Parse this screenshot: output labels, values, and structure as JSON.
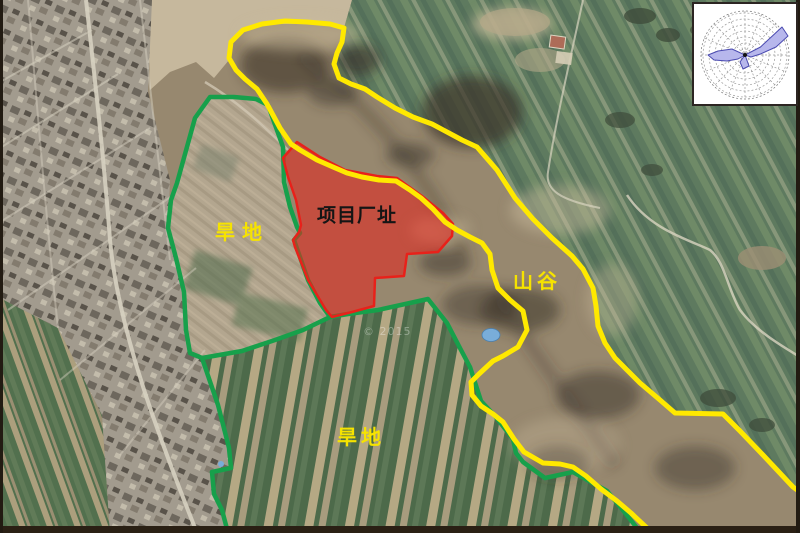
{
  "map": {
    "labels": {
      "dryland_upper": {
        "text": "旱地",
        "color": "#f6e300"
      },
      "project_site": {
        "text": "项目厂址",
        "color": "#151515"
      },
      "valley": {
        "text": "山谷",
        "color": "#f6e300"
      },
      "dryland_lower": {
        "text": "旱地",
        "color": "#f6e300"
      }
    },
    "watermark": "© 2015",
    "overlays": {
      "valley_boundary_color": "#ffe900",
      "field_boundary_color": "#17a04b",
      "project_site_fill": "#e8211a"
    },
    "features": {
      "wind_rose": {
        "icon": "wind-rose",
        "lobe_color": "#b7b7ec",
        "background": "#ffffff",
        "position": "top-right"
      },
      "pond_color": "#79add9"
    }
  }
}
